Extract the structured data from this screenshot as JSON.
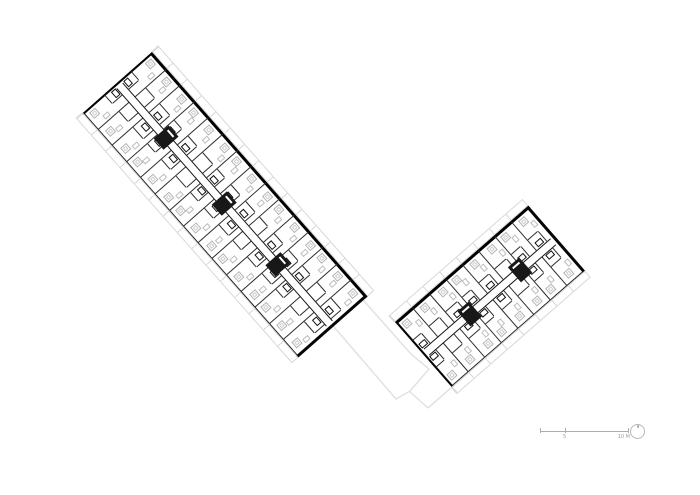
{
  "drawing": {
    "type": "architectural-floor-plan",
    "subject": "Typical upper-floor plan: two rectangular apartment wings meeting at a right angle with central corridors, ground-floor outline shown in light grey between them",
    "background": "#ffffff",
    "colors": {
      "wall": "#1f1f1f",
      "wall_bold": "#000000",
      "partition": "#2d2d2d",
      "furniture": "#b3b3b3",
      "furniture_light": "#cfcfcf",
      "balcony": "#d8d8d8",
      "ground_outline": "#e2e2e2",
      "scale": "#9b9b9b"
    },
    "wings": [
      {
        "name": "north-west-wing",
        "x": 152,
        "y": 52,
        "rotation_deg": 48.6,
        "length": 325,
        "width": 92,
        "units_per_side": 15,
        "corridor_width": 9,
        "cores": [
          0.2,
          0.47,
          0.72
        ]
      },
      {
        "name": "south-east-wing",
        "x": 395,
        "y": 322,
        "rotation_deg": -41.1,
        "length": 176,
        "width": 86,
        "units_per_side": 8,
        "corridor_width": 9,
        "cores": [
          0.3,
          0.68
        ]
      }
    ],
    "ground_outline": {
      "polygon": [
        [
          348,
          283
        ],
        [
          411,
          354
        ],
        [
          429,
          369
        ],
        [
          410,
          391
        ],
        [
          396,
          399
        ],
        [
          322,
          313
        ]
      ],
      "lines": [
        [
          409,
          391,
          428,
          408
        ],
        [
          428,
          408,
          500,
          345
        ]
      ]
    },
    "scale_bar": {
      "unit_labels": [
        {
          "text": "5"
        },
        {
          "text": "10 M"
        }
      ]
    },
    "north_arrow": {
      "symbol": "circle-with-needle"
    }
  }
}
